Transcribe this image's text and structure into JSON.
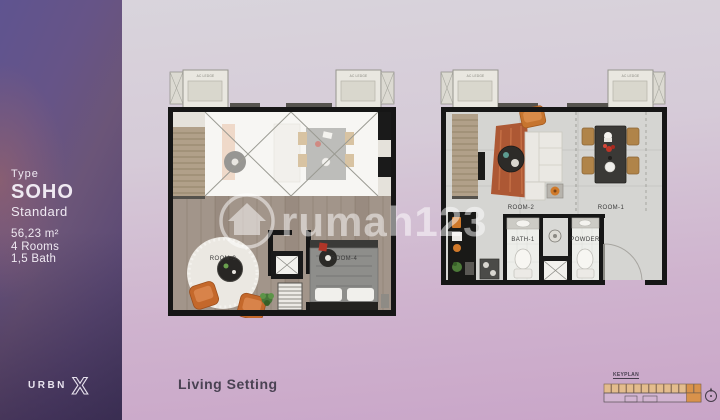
{
  "sidebar": {
    "type_label": "Type",
    "type_name": "SOHO",
    "type_variant": "Standard",
    "specs": {
      "area": "56,23 m²",
      "rooms": "4 Rooms",
      "bath": "1,5 Bath"
    },
    "logo": {
      "text": "URBN",
      "mark": "X"
    }
  },
  "caption": {
    "text": "Living Setting"
  },
  "watermark": {
    "text": "rumah123",
    "icon": "house-in-circle-icon"
  },
  "keyplan": {
    "label": "KEYPLAN",
    "unit_count": 13,
    "cell_color": "#e3bc8d",
    "highlight_color": "#d8924b",
    "compass": "compass-icon"
  },
  "floorplans": {
    "upper": {
      "title": "upper-floor-plan-with-void",
      "ac_label": "AC LEDGE",
      "rooms": [
        {
          "label": "ROOM-3"
        },
        {
          "label": "ROOM-4"
        }
      ]
    },
    "lower": {
      "title": "lower-floor-plan",
      "ac_label": "AC LEDGE",
      "rooms": [
        {
          "label": "ROOM-2"
        },
        {
          "label": "ROOM-1"
        },
        {
          "label": "BATH-1"
        },
        {
          "label": "POWDER"
        }
      ]
    }
  },
  "colors": {
    "band": "#5d4f7e",
    "background_top": "#d9d5dc",
    "background_bottom": "#c9a5c8",
    "wall": "#161616",
    "wood_floor": "#a2958a",
    "concrete_floor": "#d5d5d2",
    "accent_orange": "#c4682b"
  }
}
